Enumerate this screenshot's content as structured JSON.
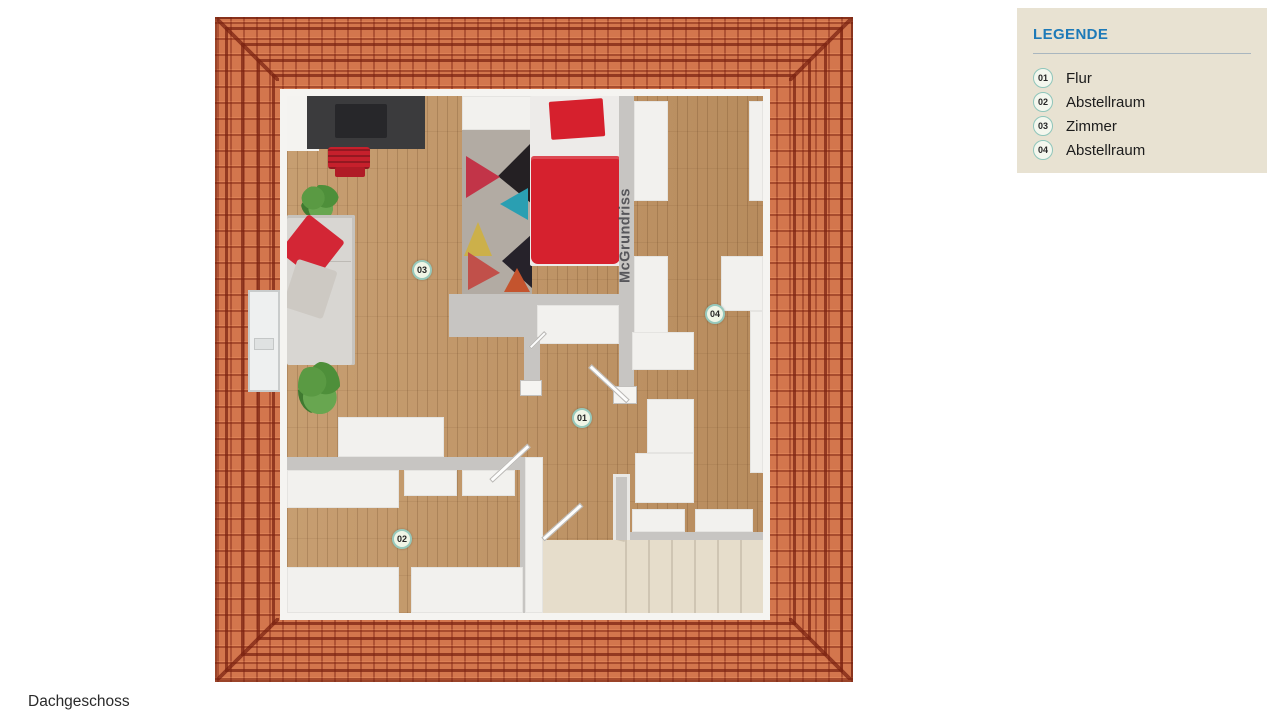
{
  "page": {
    "floor_label": "Dachgeschoss"
  },
  "legend": {
    "title": "LEGENDE",
    "items": [
      {
        "number": "01",
        "label": "Flur"
      },
      {
        "number": "02",
        "label": "Abstellraum"
      },
      {
        "number": "03",
        "label": "Zimmer"
      },
      {
        "number": "04",
        "label": "Abstellraum"
      }
    ]
  },
  "floorplan": {
    "watermark": "McGrundriss",
    "room_badges": {
      "flur": "01",
      "abstellraum_unten": "02",
      "zimmer": "03",
      "abstellraum_rechts": "04"
    },
    "colors": {
      "roof_tile": "#d3764d",
      "roof_ridge": "#7a2110",
      "wood_floor": "#bf9465",
      "wall_gray": "#c7c5c2",
      "wall_white": "#f2f1ee",
      "stairs": "#e6ddcb",
      "accent_red": "#d6212e",
      "legend_background": "#e8e2d2",
      "legend_title_blue": "#1d7ab8",
      "badge_ring": "#8fc6bb"
    }
  }
}
